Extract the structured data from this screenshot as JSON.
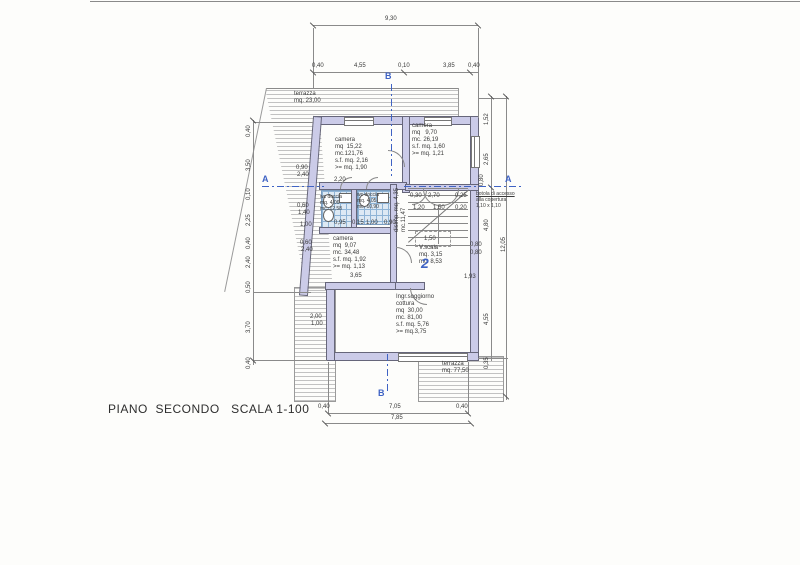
{
  "title": "PIANO  SECONDO   SCALA 1-100",
  "colors": {
    "accent_blue": "#3f63c4",
    "wall_fill": "#cbcbe8",
    "tile_line": "#8fb4d6",
    "paper": "#fdfdfb",
    "ink": "#3a3a3a"
  },
  "apartment_number": "2",
  "section_markers": [
    {
      "label": "B",
      "x": 385,
      "y": 71
    },
    {
      "label": "A",
      "x": 262,
      "y": 174
    },
    {
      "label": "A",
      "x": 505,
      "y": 174
    },
    {
      "label": "B",
      "x": 378,
      "y": 388
    }
  ],
  "rooms": [
    {
      "name": "terrazza-top",
      "x": 294,
      "y": 91,
      "cls": "",
      "lines": [
        "terrazza",
        "mq. 23,00"
      ]
    },
    {
      "name": "camera-grande",
      "x": 335,
      "y": 137,
      "cls": "",
      "lines": [
        "camera",
        "mq  15,22",
        "mc.121,76",
        "s.f. mq. 2,16",
        ">= mq. 1,90"
      ]
    },
    {
      "name": "camera-destra",
      "x": 412,
      "y": 123,
      "cls": "",
      "lines": [
        "camera",
        "mq   9,70",
        "mc. 26,19",
        "s.f. mq. 1,60",
        ">= mq. 1,21"
      ]
    },
    {
      "name": "wc-doccia-sinistra",
      "x": 320,
      "y": 194,
      "cls": "small",
      "lines": [
        "wc doccia",
        "mq. 4,06",
        "mc. 12,58"
      ]
    },
    {
      "name": "wc-doccia-destra",
      "x": 357,
      "y": 192,
      "cls": "small",
      "lines": [
        "wc doccia",
        "mq. 4,05",
        "mc. 10,90"
      ]
    },
    {
      "name": "disimpegno",
      "x": 394,
      "y": 232,
      "cls": "rot",
      "lines": [
        "disimp. mq. 4,35",
        "mc.11,47"
      ]
    },
    {
      "name": "camera-bassa",
      "x": 333,
      "y": 236,
      "cls": "",
      "lines": [
        "camera",
        "mq  9,07",
        "mc. 34,48",
        "s.f. mq. 1,92",
        ">= mq. 1,13"
      ]
    },
    {
      "name": "vano-scala",
      "x": 419,
      "y": 245,
      "cls": "",
      "lines": [
        "V.scala",
        "mq. 3,15",
        "mc. 8,53"
      ]
    },
    {
      "name": "soggiorno",
      "x": 396,
      "y": 294,
      "cls": "",
      "lines": [
        "Ingr.soggiorno",
        "cottura",
        "mq  30,00",
        "mc. 81,00",
        "s.f. mq. 5,76",
        ">= mq.3,75"
      ]
    },
    {
      "name": "terrazza-bassa",
      "x": 442,
      "y": 361,
      "cls": "",
      "lines": [
        "terrazza",
        "mq. 77,50"
      ]
    },
    {
      "name": "botola-nota",
      "x": 476,
      "y": 191,
      "cls": "small u1",
      "lines": [
        "botola di accesso",
        "alla copertura",
        "1,10 x 1,10"
      ]
    }
  ],
  "dims": [
    {
      "t": "9,30",
      "x": 385,
      "y": 16
    },
    {
      "t": "0,40",
      "x": 312,
      "y": 63
    },
    {
      "t": "4,55",
      "x": 354,
      "y": 63
    },
    {
      "t": "0,10",
      "x": 398,
      "y": 63
    },
    {
      "t": "3,85",
      "x": 443,
      "y": 63
    },
    {
      "t": "0,40",
      "x": 468,
      "y": 63
    },
    {
      "t": "0,40",
      "x": 318,
      "y": 404
    },
    {
      "t": "7,05",
      "x": 389,
      "y": 404
    },
    {
      "t": "0,40",
      "x": 456,
      "y": 404
    },
    {
      "t": "7,85",
      "x": 391,
      "y": 415
    },
    {
      "t": "0,40",
      "x": 246,
      "y": 137,
      "rot": true
    },
    {
      "t": "3,50",
      "x": 246,
      "y": 171,
      "rot": true
    },
    {
      "t": "0,10",
      "x": 246,
      "y": 200,
      "rot": true
    },
    {
      "t": "2,25",
      "x": 246,
      "y": 226,
      "rot": true
    },
    {
      "t": "0,40",
      "x": 246,
      "y": 249,
      "rot": true
    },
    {
      "t": "2,40",
      "x": 246,
      "y": 268,
      "rot": true
    },
    {
      "t": "0,50",
      "x": 246,
      "y": 293,
      "rot": true
    },
    {
      "t": "3,70",
      "x": 246,
      "y": 333,
      "rot": true
    },
    {
      "t": "0,40",
      "x": 246,
      "y": 369,
      "rot": true
    },
    {
      "t": "1,52",
      "x": 484,
      "y": 125,
      "rot": true
    },
    {
      "t": "2,65",
      "x": 484,
      "y": 165,
      "rot": true
    },
    {
      "t": "0,80",
      "x": 479,
      "y": 186,
      "rot": true
    },
    {
      "t": "4,80",
      "x": 484,
      "y": 231,
      "rot": true
    },
    {
      "t": "4,55",
      "x": 484,
      "y": 325,
      "rot": true
    },
    {
      "t": "0,35",
      "x": 484,
      "y": 369,
      "rot": true
    },
    {
      "t": "12,05",
      "x": 501,
      "y": 252,
      "rot": true
    },
    {
      "t": "0,80",
      "x": 470,
      "y": 242
    },
    {
      "t": "0,80",
      "x": 470,
      "y": 250
    },
    {
      "t": "1,93",
      "x": 464,
      "y": 274
    },
    {
      "t": "0,90",
      "x": 296,
      "y": 165
    },
    {
      "t": "2,40",
      "x": 297,
      "y": 172
    },
    {
      "t": "0,60",
      "x": 297,
      "y": 203
    },
    {
      "t": "1,40",
      "x": 298,
      "y": 210
    },
    {
      "t": "1,00",
      "x": 300,
      "y": 222
    },
    {
      "t": "0,60",
      "x": 300,
      "y": 240
    },
    {
      "t": "2,40",
      "x": 301,
      "y": 247
    },
    {
      "t": "2,00",
      "x": 310,
      "y": 314
    },
    {
      "t": "1,00",
      "x": 311,
      "y": 321
    },
    {
      "t": "2,20",
      "x": 334,
      "y": 177
    },
    {
      "t": "0,95",
      "x": 334,
      "y": 220
    },
    {
      "t": "0,15",
      "x": 352,
      "y": 220
    },
    {
      "t": "1,00",
      "x": 366,
      "y": 220
    },
    {
      "t": "0,90",
      "x": 384,
      "y": 220
    },
    {
      "t": "3,65",
      "x": 350,
      "y": 273
    },
    {
      "t": "0,30",
      "x": 410,
      "y": 193
    },
    {
      "t": "2,70",
      "x": 428,
      "y": 193
    },
    {
      "t": "0,25",
      "x": 455,
      "y": 193
    },
    {
      "t": "1,20",
      "x": 413,
      "y": 205
    },
    {
      "t": "1,50",
      "x": 433,
      "y": 205
    },
    {
      "t": "0,20",
      "x": 455,
      "y": 205
    },
    {
      "t": "1,50",
      "x": 424,
      "y": 236
    }
  ]
}
